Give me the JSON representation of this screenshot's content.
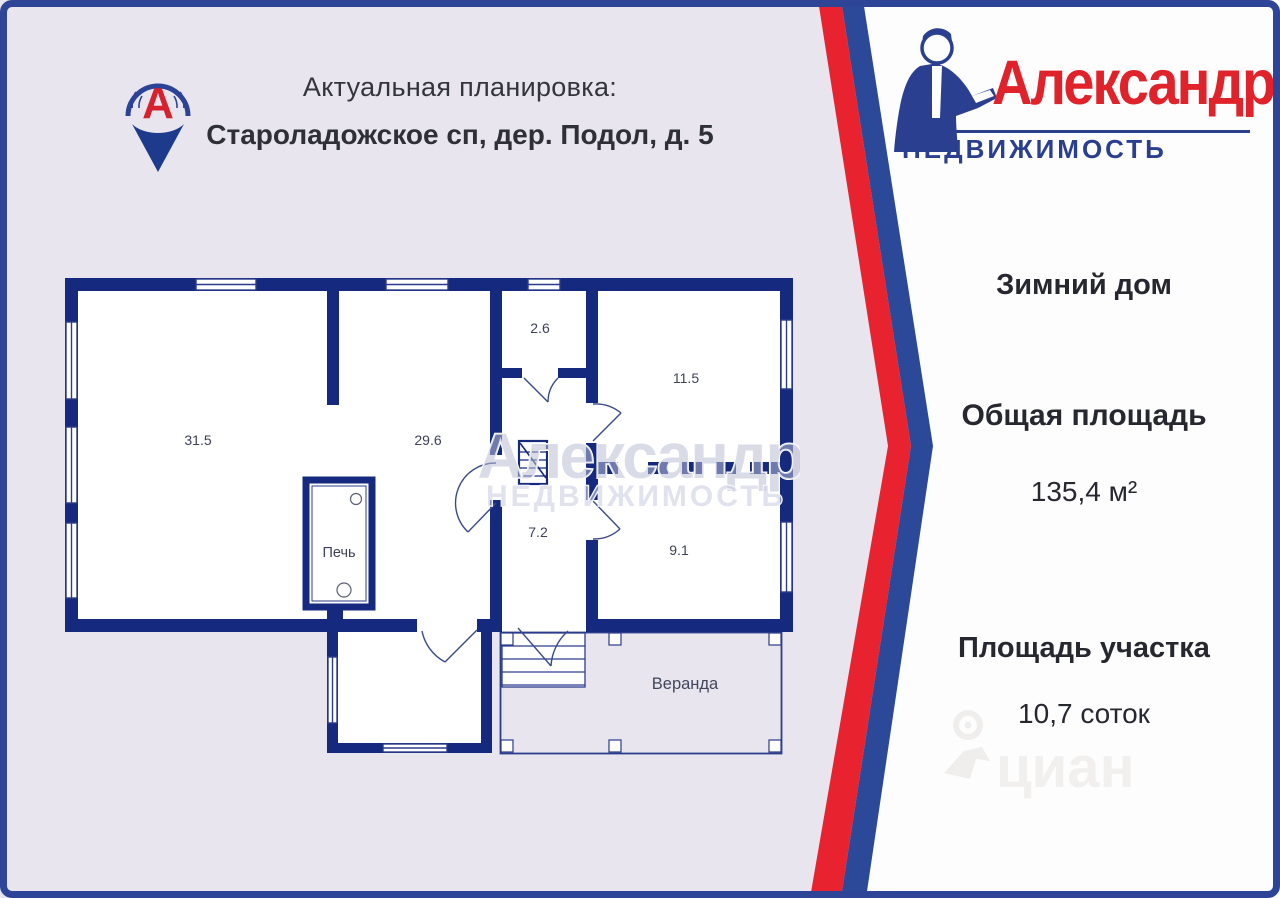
{
  "header": {
    "line1": "Актуальная планировка:",
    "line2": "Староладожское сп, дер. Подол, д. 5"
  },
  "pin_logo": {
    "letter": "А"
  },
  "brand": {
    "title": "Александр",
    "subtitle": "НЕДВИЖИМОСТЬ"
  },
  "panel": {
    "house_type": "Зимний дом",
    "total_area_label": "Общая площадь",
    "total_area_value": "135,4 м²",
    "plot_area_label": "Площадь участка",
    "plot_area_value": "10,7 соток"
  },
  "plan": {
    "rooms": {
      "r31_5": "31.5",
      "r29_6": "29.6",
      "r2_6": "2.6",
      "r11_5": "11.5",
      "r7_2": "7.2",
      "r9_1": "9.1"
    },
    "stove_label": "Печь",
    "veranda_label": "Веранда"
  },
  "watermarks": {
    "plan_line1": "Александр",
    "plan_line2": "НЕДВИЖИМОСТЬ",
    "cian": "циан"
  },
  "colors": {
    "background": "#e8e5ee",
    "frame_blue": "#2e4597",
    "wall_navy": "#15297e",
    "chevron_red": "#e8232f",
    "chevron_blue": "#2c4899",
    "brand_red": "#e0232b",
    "brand_blue": "#2b3f90",
    "text_dark": "#26272f",
    "room_label": "#3d4257"
  }
}
